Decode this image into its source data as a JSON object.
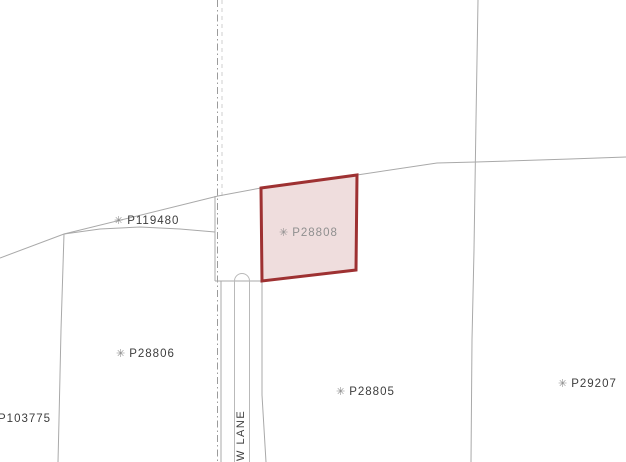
{
  "map": {
    "width": 626,
    "height": 462,
    "colors": {
      "background": "#ffffff",
      "boundary_line": "#a9a9a9",
      "centerline": "#9b9b9b",
      "light_dashed": "#cfcfcf",
      "road_casing": "#b9b9b9",
      "label_text": "#3d3d3d",
      "marker": "#8a8a8a",
      "selected_stroke": "#9e3132",
      "selected_fill": "#efdddd",
      "selected_label": "#8f8f8f"
    },
    "selected_parcel": {
      "id": "P28808",
      "label": {
        "text": "P28808",
        "marker_icon": "✳",
        "x": 279,
        "y": 225
      },
      "points": [
        [
          261,
          188
        ],
        [
          357,
          175
        ],
        [
          356,
          270
        ],
        [
          262,
          281
        ]
      ]
    },
    "labels": [
      {
        "text": "P119480",
        "marker_icon": "✳",
        "x": 114,
        "y": 213
      },
      {
        "text": "P28806",
        "marker_icon": "✳",
        "x": 116,
        "y": 346
      },
      {
        "text": "P103775",
        "marker_icon": "",
        "x": -2,
        "y": 411
      },
      {
        "text": "P28805",
        "marker_icon": "✳",
        "x": 336,
        "y": 384
      },
      {
        "text": "P29207",
        "marker_icon": "✳",
        "x": 558,
        "y": 376
      }
    ],
    "road": {
      "name": "W LANE",
      "anchor_x": 235,
      "anchor_y": 461
    },
    "geometry": {
      "boundary_lines": [
        {
          "name": "boundary-west-diagonal",
          "points": [
            [
              0,
              258
            ],
            [
              64,
              234
            ],
            [
              218,
              196
            ],
            [
              261,
              188
            ]
          ]
        },
        {
          "name": "boundary-strip-curve",
          "points": [
            [
              64,
              234
            ],
            [
              100,
              229
            ],
            [
              140,
              227
            ],
            [
              180,
              229
            ],
            [
              215,
              232
            ]
          ]
        },
        {
          "name": "boundary-west-vertical",
          "points": [
            [
              64,
              234
            ],
            [
              61,
              330
            ],
            [
              59,
              420
            ],
            [
              58,
              462
            ]
          ]
        },
        {
          "name": "boundary-east-upper",
          "points": [
            [
              357,
              175
            ],
            [
              437,
              163
            ],
            [
              476,
              162
            ],
            [
              570,
              159
            ],
            [
              626,
              157
            ]
          ]
        },
        {
          "name": "boundary-east-vertical",
          "points": [
            [
              478,
              0
            ],
            [
              476,
              120
            ],
            [
              474,
              250
            ],
            [
              472,
              340
            ],
            [
              471,
              462
            ]
          ]
        },
        {
          "name": "road-west-edge-upper",
          "points": [
            [
              215,
              196
            ],
            [
              215,
              281
            ]
          ]
        },
        {
          "name": "road-cross-line",
          "points": [
            [
              215,
              281
            ],
            [
              262,
              281
            ]
          ]
        },
        {
          "name": "road-west-edge-lower",
          "points": [
            [
              221,
              281
            ],
            [
              221,
              462
            ]
          ]
        },
        {
          "name": "road-east-edge",
          "points": [
            [
              262,
              281
            ],
            [
              262,
              395
            ],
            [
              266,
              462
            ]
          ]
        }
      ],
      "centerline": {
        "points": [
          [
            217.5,
            0
          ],
          [
            217.5,
            462
          ]
        ],
        "dasharray": "7 3 1.5 3"
      },
      "light_dashed": {
        "points": [
          [
            222,
            0
          ],
          [
            222,
            196
          ]
        ],
        "dasharray": "4 4"
      },
      "road_casing_path": "M 234.5 462 L 234.5 281 A 7.5 7.5 0 0 1 249.5 281 L 249.5 462"
    }
  }
}
